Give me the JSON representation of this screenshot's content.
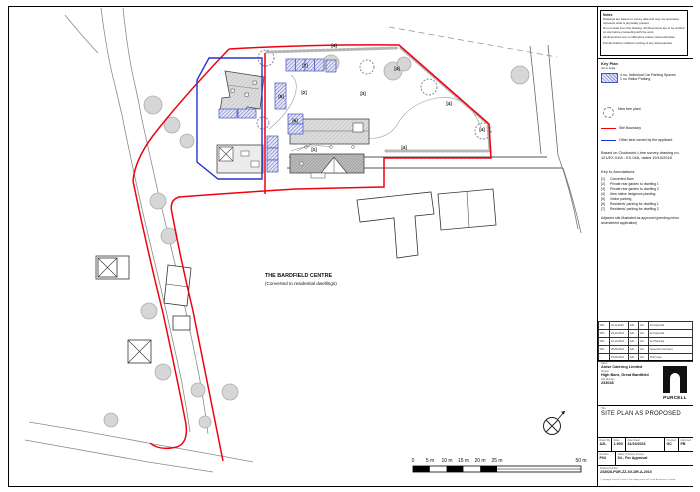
{
  "colors": {
    "site_boundary": "#f00110",
    "other_land": "#2735cc",
    "parking_line": "#4953b8",
    "parking_fill": "#e4e7f7"
  },
  "plan": {
    "bardfield": {
      "line1": "THE BARDFIELD CENTRE",
      "line2": "(Converted to residential dwellings)"
    },
    "labels": [
      "[7]",
      "[5]",
      "[6]",
      "[2]",
      "[3]",
      "[1]",
      "[4]",
      "[4]",
      "[4]",
      "[4]",
      "[4]"
    ],
    "scalebar": [
      "0",
      "5 m",
      "10 m",
      "15 m",
      "20 m",
      "25 m",
      "50 m"
    ]
  },
  "titleblock": {
    "notes": {
      "title": "Notes",
      "lines": [
        "Drawings are based on survey data and may not accurately represent what is physically present.",
        "Do not scale from this drawing. All dimensions are to be verified on site before proceeding with the work.",
        "All dimensions are in millimetres unless noted otherwise.",
        "Purcell shall be notified in writing of any discrepancies."
      ]
    },
    "key_plan": {
      "title": "Key Plan",
      "subtitle": "not to scale",
      "parking_label_line1": "4 no. Individual Car Parking Spaces",
      "parking_label_line2": "1 no Visitor Parking",
      "tree_label": "New tree plant",
      "site_boundary_label": "Site Boundary",
      "other_land_label": "Other land owned by the applicant.",
      "survey_note": "Based on Clockwork Lime survey drawing no. 121/EX.01/A - EX.04A, dated 19/10/2018",
      "annotations_title": "Key to Annotations",
      "annotations": [
        {
          "ref": "[1]",
          "text": "Converted  Barn"
        },
        {
          "ref": "[2]",
          "text": "Private rear garden to dwelling 1"
        },
        {
          "ref": "[3]",
          "text": "Private rear garden to dwelling 2"
        },
        {
          "ref": "[4]",
          "text": "New native hedgerow planting"
        },
        {
          "ref": "[5]",
          "text": "Visitor parking"
        },
        {
          "ref": "[6]",
          "text": "Residents' parking for dwelling 1"
        },
        {
          "ref": "[7]",
          "text": "Residents' parking for dwelling 2"
        }
      ],
      "adjacent_note": "Adjacent site illustrated as approved (pending minor amendment application)"
    },
    "revisions": [
      [
        "P04",
        "01-11-2023",
        "AZL",
        "GC",
        "For Approval"
      ],
      [
        "P03",
        "24-10-2023",
        "AZL",
        "GC",
        "For Approval"
      ],
      [
        "P02",
        "10-10-2023",
        "AZL",
        "GC",
        "For Planning"
      ],
      [
        "P01",
        "28-09-2023",
        "AZL",
        "GC",
        "Issued for Comment"
      ],
      [
        "-",
        "15-09-2023",
        "AZL",
        "GC",
        "First Issue"
      ]
    ],
    "project": {
      "client_label": "Client",
      "client": "Anise Catering Limited",
      "project_label": "Project",
      "project": "High Barn, Great Bardfield",
      "job_label": "Job Number",
      "job_number": "233028",
      "logo_word": "PURCELL",
      "title_label": "Title",
      "title": "SITE PLAN AS PROPOSED"
    },
    "meta": {
      "fields": [
        {
          "label": "Drawn By",
          "value": "AZL"
        },
        {
          "label": "Scale",
          "value": "1:500"
        },
        {
          "label": "Date Drawn",
          "value": "31/10/2023"
        },
        {
          "label": "Checked",
          "value": "GC"
        },
        {
          "label": "Approved",
          "value": "PB"
        }
      ],
      "revision_label": "Revision",
      "revision": "P04",
      "status_label": "Status / Purpose of Issue",
      "status": "S4 - For Approval",
      "drawing_number_label": "Drawing Number",
      "drawing_number": "233028-PUR-ZZ-XX-DR-A-2010",
      "footer": "© copyright Purcell. Purcell is the trading name of Purcell Architecture Limited."
    }
  }
}
